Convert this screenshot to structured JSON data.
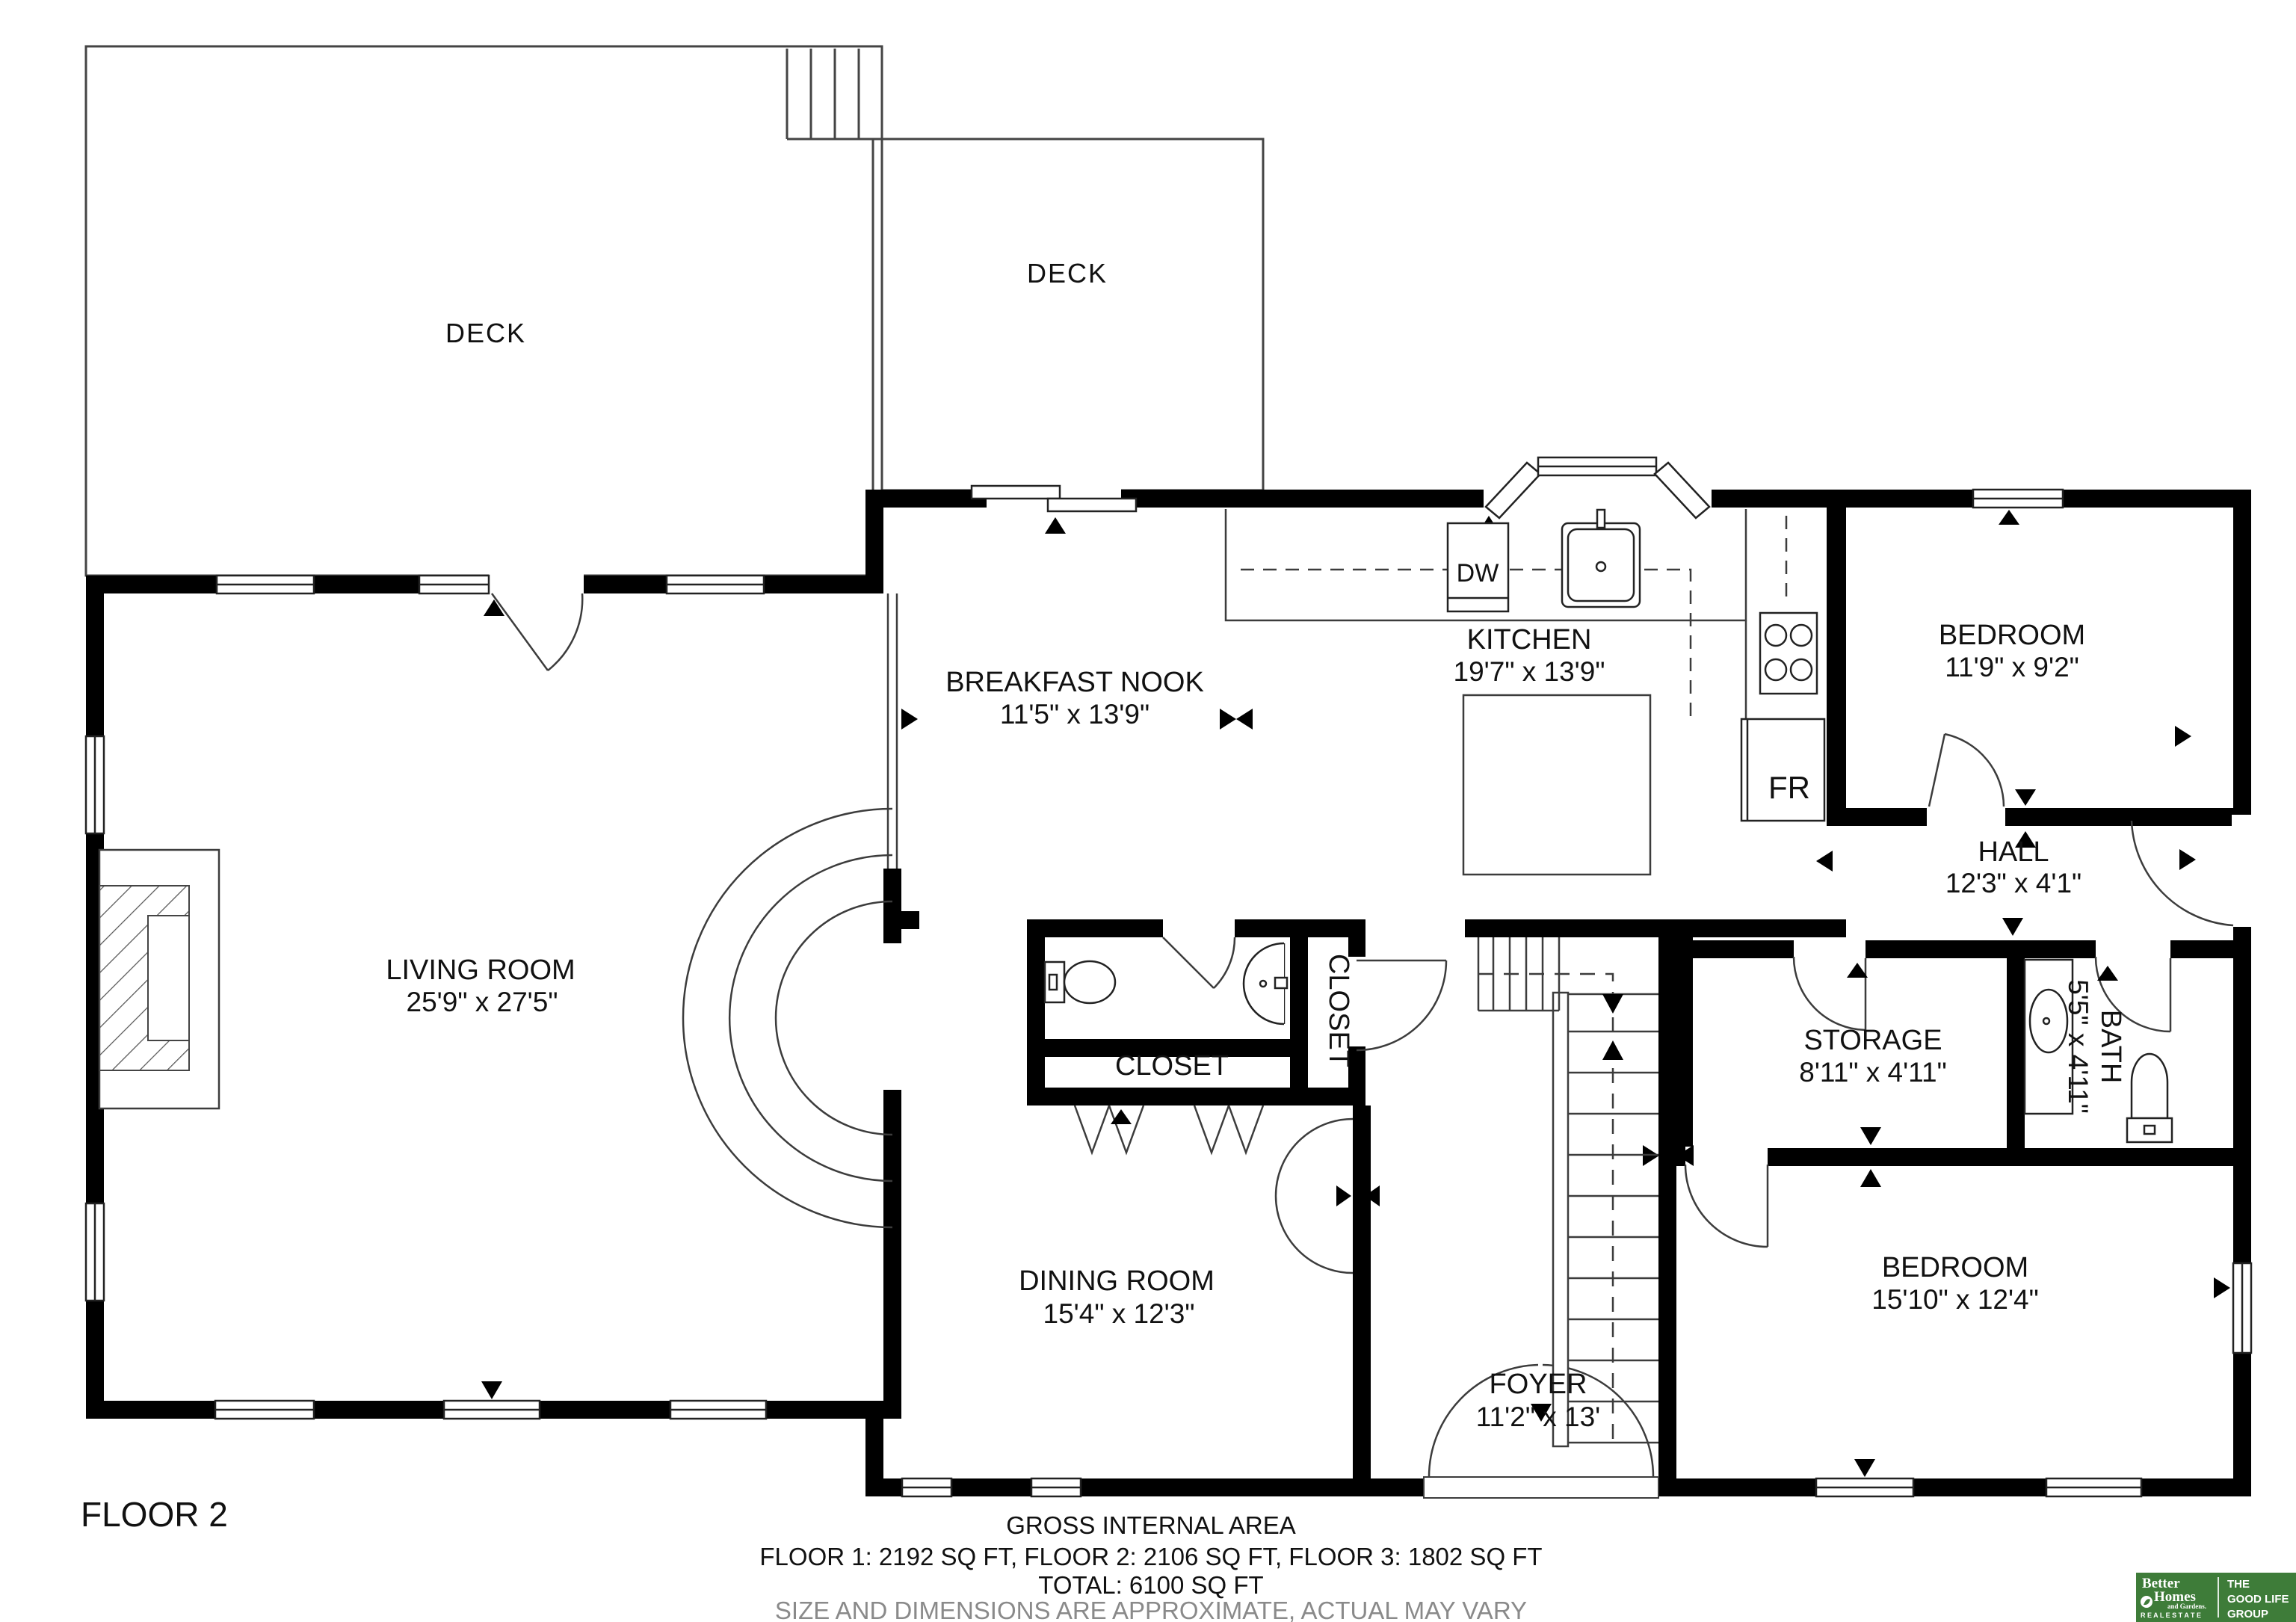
{
  "floor_label": "FLOOR 2",
  "rooms": {
    "deck_left": {
      "label": "DECK"
    },
    "deck_right": {
      "label": "DECK"
    },
    "breakfast_nook": {
      "label": "BREAKFAST NOOK",
      "dims": "11'5\" x 13'9\""
    },
    "kitchen": {
      "label": "KITCHEN",
      "dims": "19'7\" x 13'9\""
    },
    "bedroom_upper": {
      "label": "BEDROOM",
      "dims": "11'9\" x 9'2\""
    },
    "hall": {
      "label": "HALL",
      "dims": "12'3\" x 4'1\""
    },
    "living_room": {
      "label": "LIVING ROOM",
      "dims": "25'9\" x 27'5\""
    },
    "storage": {
      "label": "STORAGE",
      "dims": "8'11\" x 4'11\""
    },
    "bath": {
      "label": "BATH",
      "dims": "5'5\" x 4'11\""
    },
    "closet_hall": {
      "label": "CLOSET"
    },
    "closet_side": {
      "label": "CLOSET"
    },
    "dining_room": {
      "label": "DINING ROOM",
      "dims": "15'4\" x 12'3\""
    },
    "foyer": {
      "label": "FOYER",
      "dims": "11'2\" x 13'"
    },
    "bedroom_lower": {
      "label": "BEDROOM",
      "dims": "15'10\" x 12'4\""
    }
  },
  "appliances": {
    "dishwasher": "DW",
    "fridge": "FR"
  },
  "footer": {
    "area_title": "GROSS INTERNAL AREA",
    "area_breakdown": "FLOOR 1: 2192 SQ FT, FLOOR 2: 2106 SQ FT, FLOOR 3: 1802 SQ FT",
    "area_total": "TOTAL: 6100 SQ FT",
    "disclaimer": "SIZE AND DIMENSIONS ARE APPROXIMATE, ACTUAL MAY VARY"
  },
  "logo": {
    "brand_line1": "Better",
    "brand_line2": "Homes",
    "brand_line3": "and Gardens.",
    "brand_line4": "R E A L   E S T A T E",
    "group_line1": "THE",
    "group_line2": "GOOD LIFE",
    "group_line3": "GROUP"
  },
  "colors": {
    "wall": "#000000",
    "thin_line": "#3c3c3c",
    "text": "#111111",
    "muted_text": "#8a8a8a",
    "logo_green": "#3e7c39"
  }
}
